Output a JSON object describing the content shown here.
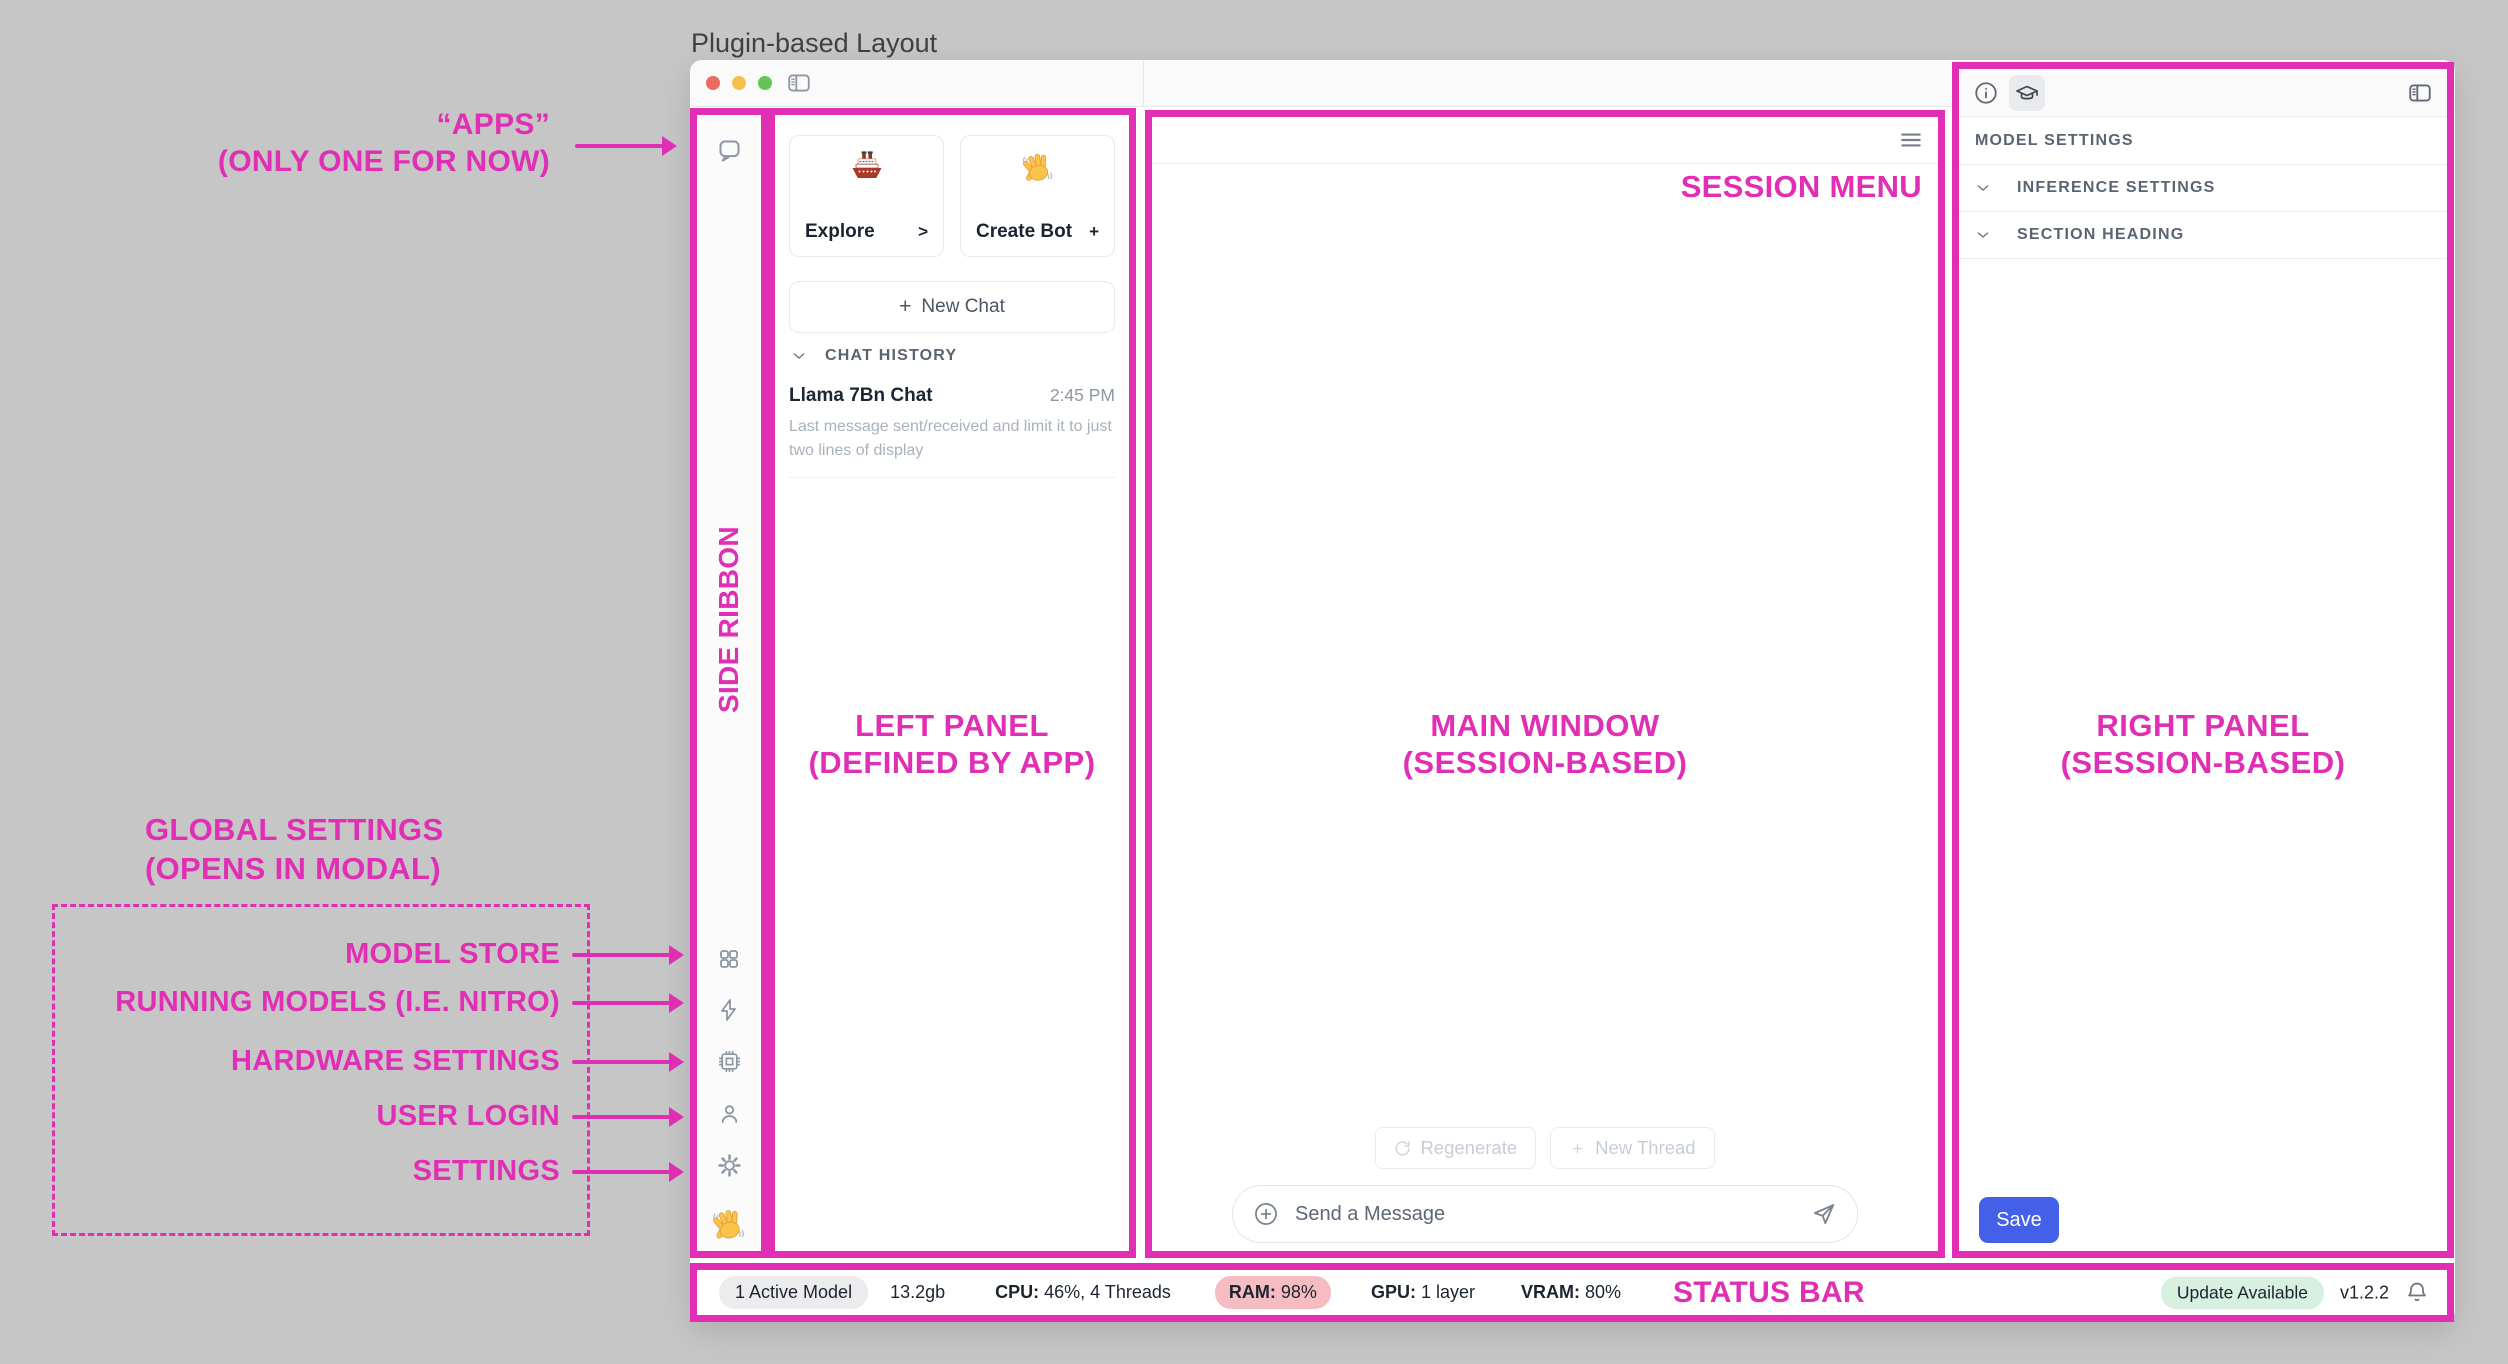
{
  "title": "Plugin-based Layout",
  "colors": {
    "magenta": "#e02fb4",
    "save-blue": "#4560e8"
  },
  "annotations": {
    "apps_line1": "“APPS”",
    "apps_line2": "(ONLY ONE FOR NOW)",
    "side_ribbon": "SIDE RIBBON",
    "left_panel_line1": "LEFT PANEL",
    "left_panel_line2": "(DEFINED BY APP)",
    "main_window_line1": "MAIN WINDOW",
    "main_window_line2": "(SESSION-BASED)",
    "right_panel_line1": "RIGHT PANEL",
    "right_panel_line2": "(SESSION-BASED)",
    "session_menu": "SESSION MENU",
    "status_bar": "STATUS BAR",
    "global_settings_line1": "GLOBAL SETTINGS",
    "global_settings_line2": "(OPENS IN MODAL)",
    "modal_items": [
      "MODEL STORE",
      "RUNNING MODELS (I.E. NITRO)",
      "HARDWARE SETTINGS",
      "USER LOGIN",
      "SETTINGS"
    ]
  },
  "left_panel": {
    "explore_label": "Explore",
    "explore_affordance": ">",
    "create_bot_label": "Create Bot",
    "create_bot_affordance": "+",
    "new_chat_plus": "+",
    "new_chat_label": "New Chat",
    "chat_history_header": "CHAT HISTORY",
    "chat_item_title": "Llama 7Bn Chat",
    "chat_item_time": "2:45 PM",
    "chat_item_preview": "Last message sent/received and limit it to just two lines of display"
  },
  "main_window": {
    "regenerate_label": "Regenerate",
    "new_thread_label": "New Thread",
    "message_placeholder": "Send a Message"
  },
  "right_panel": {
    "model_settings_header": "MODEL SETTINGS",
    "inference_settings_header": "INFERENCE SETTINGS",
    "section_heading_header": "SECTION HEADING",
    "save_label": "Save"
  },
  "status_bar": {
    "active_models": "1 Active Model",
    "memory": "13.2gb",
    "cpu_label": "CPU:",
    "cpu_value": "46%, 4 Threads",
    "ram_label": "RAM:",
    "ram_value": "98%",
    "gpu_label": "GPU:",
    "gpu_value": "1 layer",
    "vram_label": "VRAM:",
    "vram_value": "80%",
    "update_badge": "Update Available",
    "version": "v1.2.2"
  }
}
